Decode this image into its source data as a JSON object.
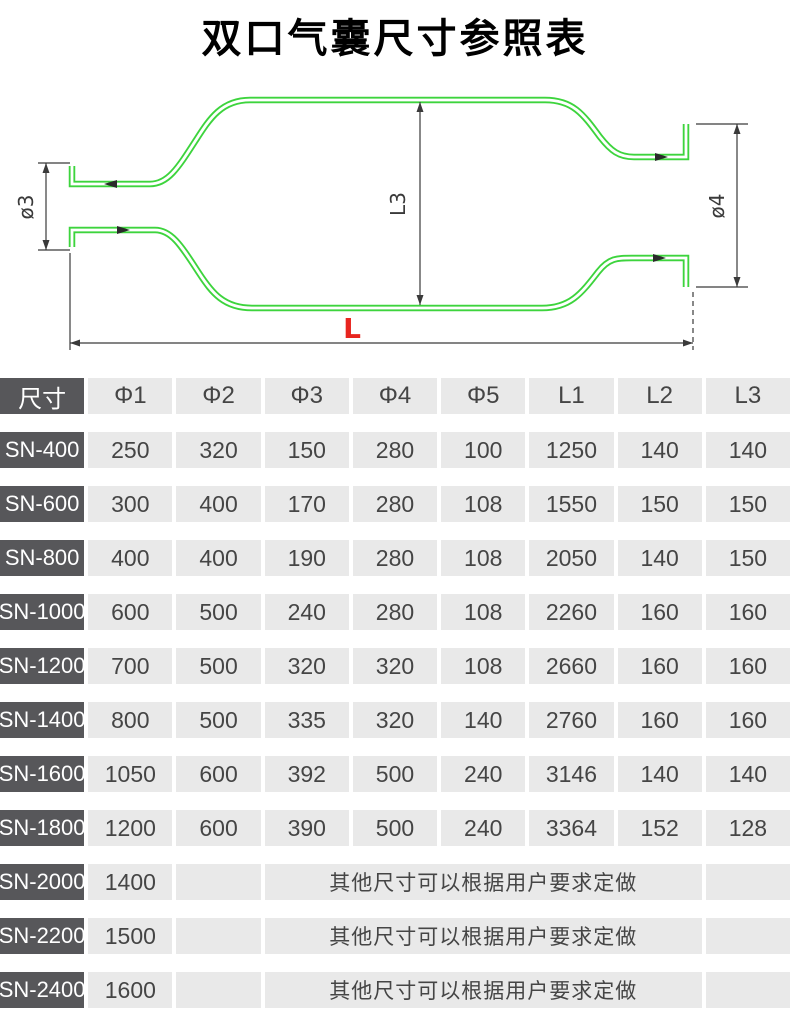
{
  "title": "双口气囊尺寸参照表",
  "diagram": {
    "labels": {
      "phi3": "ø3",
      "phi4": "ø4",
      "l3": "L3",
      "l": "L"
    },
    "colors": {
      "outline_green": "#3dd43d",
      "dimension_gray": "#3a3a3a",
      "l_label_red": "#e8251f"
    }
  },
  "table": {
    "header": [
      "尺寸",
      "Φ1",
      "Φ2",
      "Φ3",
      "Φ4",
      "Φ5",
      "L1",
      "L2",
      "L3"
    ],
    "rows": [
      {
        "label": "SN-400",
        "values": [
          "250",
          "320",
          "150",
          "280",
          "100",
          "1250",
          "140",
          "140"
        ]
      },
      {
        "label": "SN-600",
        "values": [
          "300",
          "400",
          "170",
          "280",
          "108",
          "1550",
          "150",
          "150"
        ]
      },
      {
        "label": "SN-800",
        "values": [
          "400",
          "400",
          "190",
          "280",
          "108",
          "2050",
          "140",
          "150"
        ]
      },
      {
        "label": "SN-1000",
        "values": [
          "600",
          "500",
          "240",
          "280",
          "108",
          "2260",
          "160",
          "160"
        ]
      },
      {
        "label": "SN-1200",
        "values": [
          "700",
          "500",
          "320",
          "320",
          "108",
          "2660",
          "160",
          "160"
        ]
      },
      {
        "label": "SN-1400",
        "values": [
          "800",
          "500",
          "335",
          "320",
          "140",
          "2760",
          "160",
          "160"
        ]
      },
      {
        "label": "SN-1600",
        "values": [
          "1050",
          "600",
          "392",
          "500",
          "240",
          "3146",
          "140",
          "140"
        ]
      },
      {
        "label": "SN-1800",
        "values": [
          "1200",
          "600",
          "390",
          "500",
          "240",
          "3364",
          "152",
          "128"
        ]
      },
      {
        "label": "SN-2000",
        "phi1": "1400",
        "note": "其他尺寸可以根据用户要求定做"
      },
      {
        "label": "SN-2200",
        "phi1": "1500",
        "note": "其他尺寸可以根据用户要求定做"
      },
      {
        "label": "SN-2400",
        "phi1": "1600",
        "note": "其他尺寸可以根据用户要求定做"
      }
    ],
    "colors": {
      "label_bg": "#57575a",
      "label_text": "#ffffff",
      "cell_bg": "#e9e9e9",
      "cell_text": "#454545"
    }
  }
}
